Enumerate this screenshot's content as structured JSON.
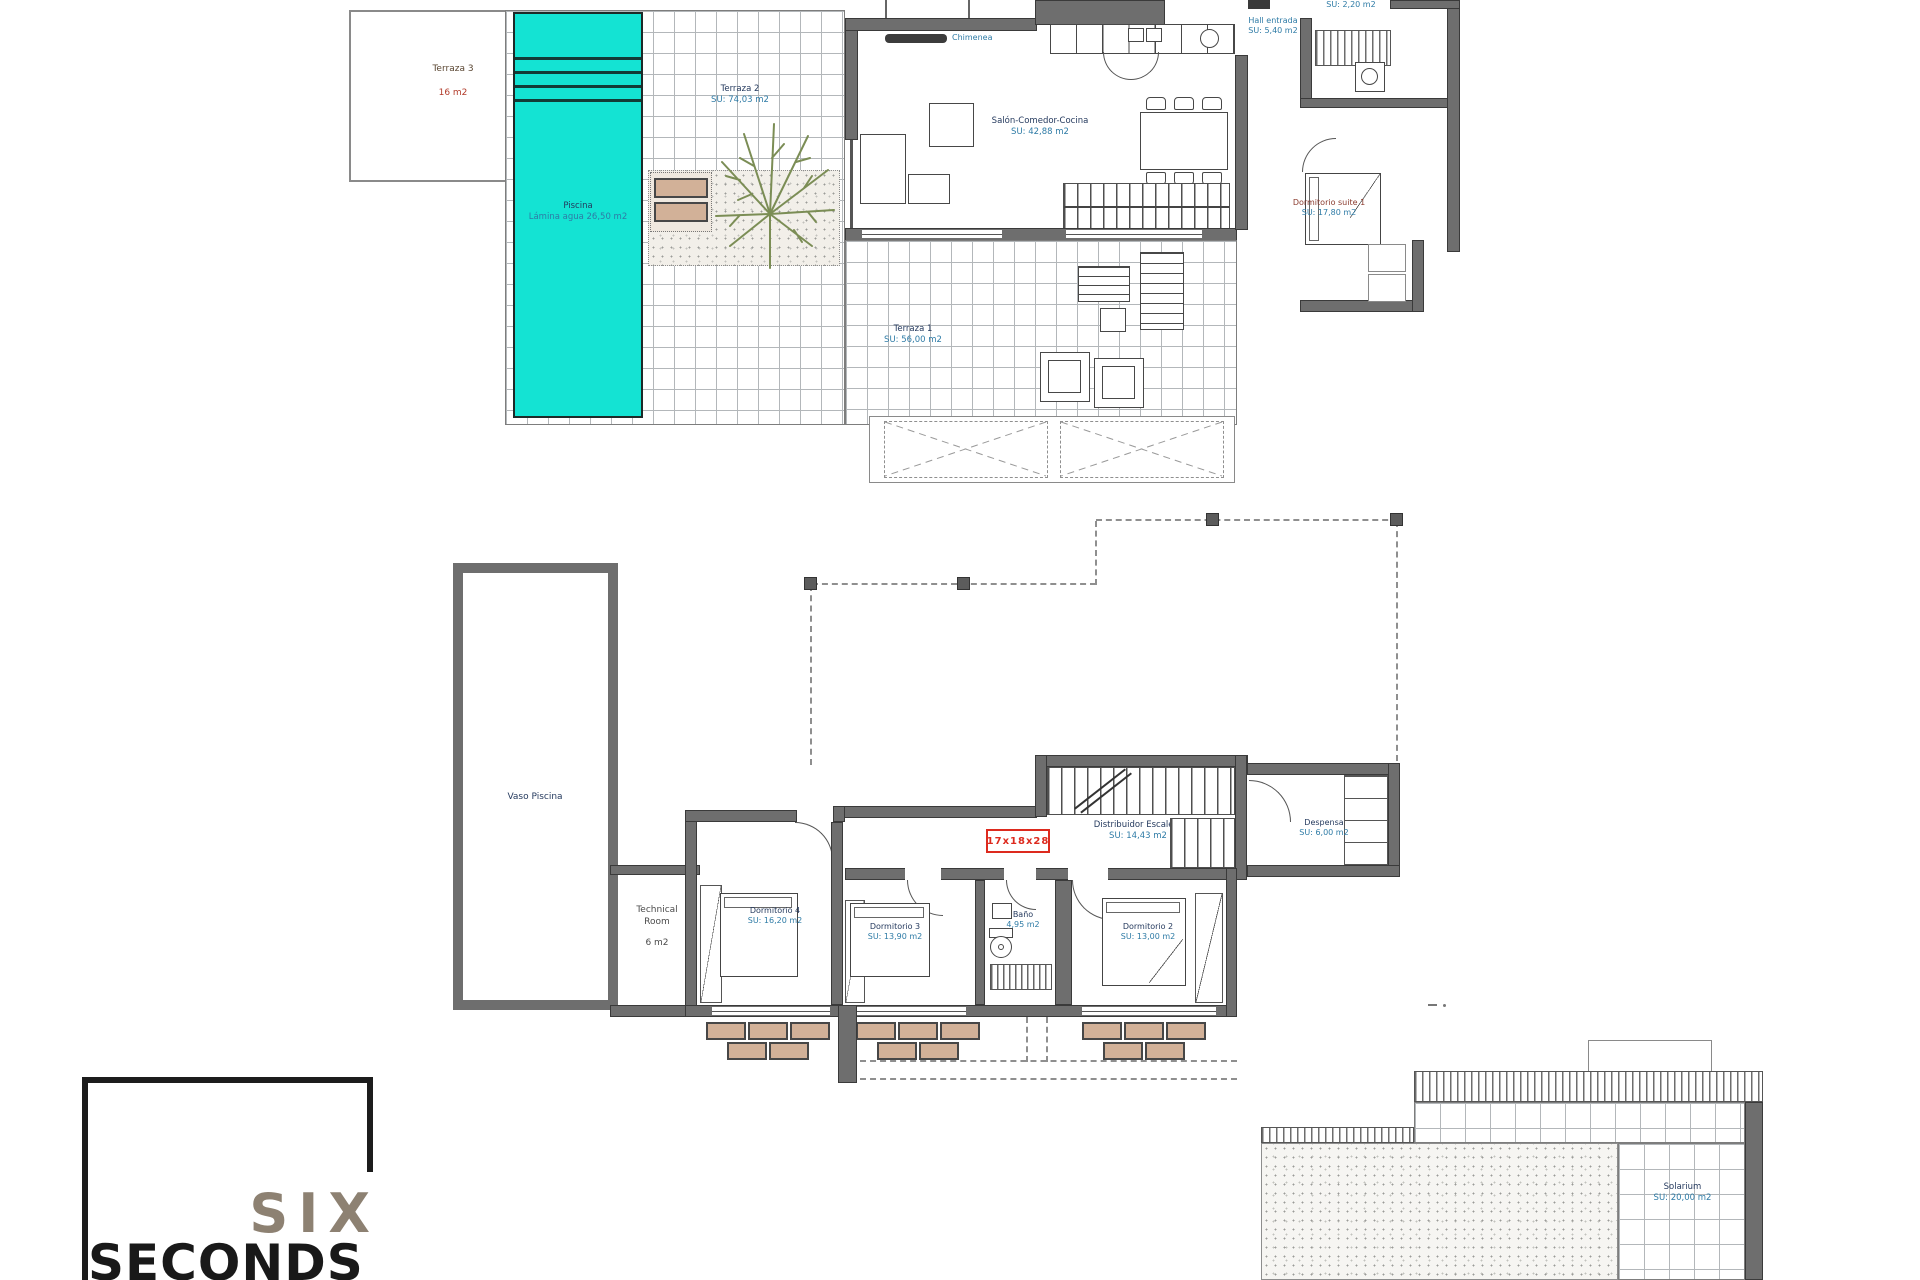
{
  "colors": {
    "pool": "#14e3d3",
    "wall": "#6e6e6e",
    "planter_tan": "#d2b198",
    "stamp_red": "#dd2a1e",
    "label_name": "#253a5e",
    "label_area": "#2e7ba6",
    "logo_six": "#8d8172",
    "logo_seconds": "#191919"
  },
  "ground_floor": {
    "terraza3": {
      "name": "Terraza 3",
      "area": "16 m2"
    },
    "terraza2": {
      "name": "Terraza 2",
      "area": "SU: 74,03 m2"
    },
    "piscina": {
      "name": "Piscina",
      "area": "Lámina agua 26,50 m2"
    },
    "salon": {
      "name": "Salón-Comedor-Cocina",
      "area": "SU: 42,88 m2"
    },
    "chimenea": {
      "name": "Chimenea"
    },
    "hall": {
      "name": "Hall entrada",
      "area": "SU: 5,40 m2"
    },
    "aseo": {
      "area": "SU: 2,20 m2"
    },
    "suite": {
      "name": "Dormitorio suite 1",
      "area": "SU: 17,80 m2"
    },
    "terraza1": {
      "name": "Terraza 1",
      "area": "SU: 56,00 m2"
    }
  },
  "first_floor": {
    "vaso": {
      "name": "Vaso Piscina"
    },
    "technical": {
      "line1": "Technical",
      "line2": "Room",
      "area": "6 m2"
    },
    "dorm4": {
      "name": "Dormitorio 4",
      "area": "SU: 16,20 m2"
    },
    "dorm3": {
      "name": "Dormitorio 3",
      "area": "SU: 13,90 m2"
    },
    "bano": {
      "name": "Baño",
      "area": "4,95 m2"
    },
    "dorm2": {
      "name": "Dormitorio 2",
      "area": "SU: 13,00 m2"
    },
    "distribuidor": {
      "name": "Distribuidor Escalera",
      "area": "SU: 14,43 m2"
    },
    "despensa": {
      "name": "Despensa",
      "area": "SU: 6,00 m2"
    },
    "stair_stamp": "17x18x28"
  },
  "roof": {
    "solarium": {
      "name": "Solarium",
      "area": "SU: 20,00 m2"
    }
  },
  "logo": {
    "line1": "SIX",
    "line2": "SECONDS"
  }
}
